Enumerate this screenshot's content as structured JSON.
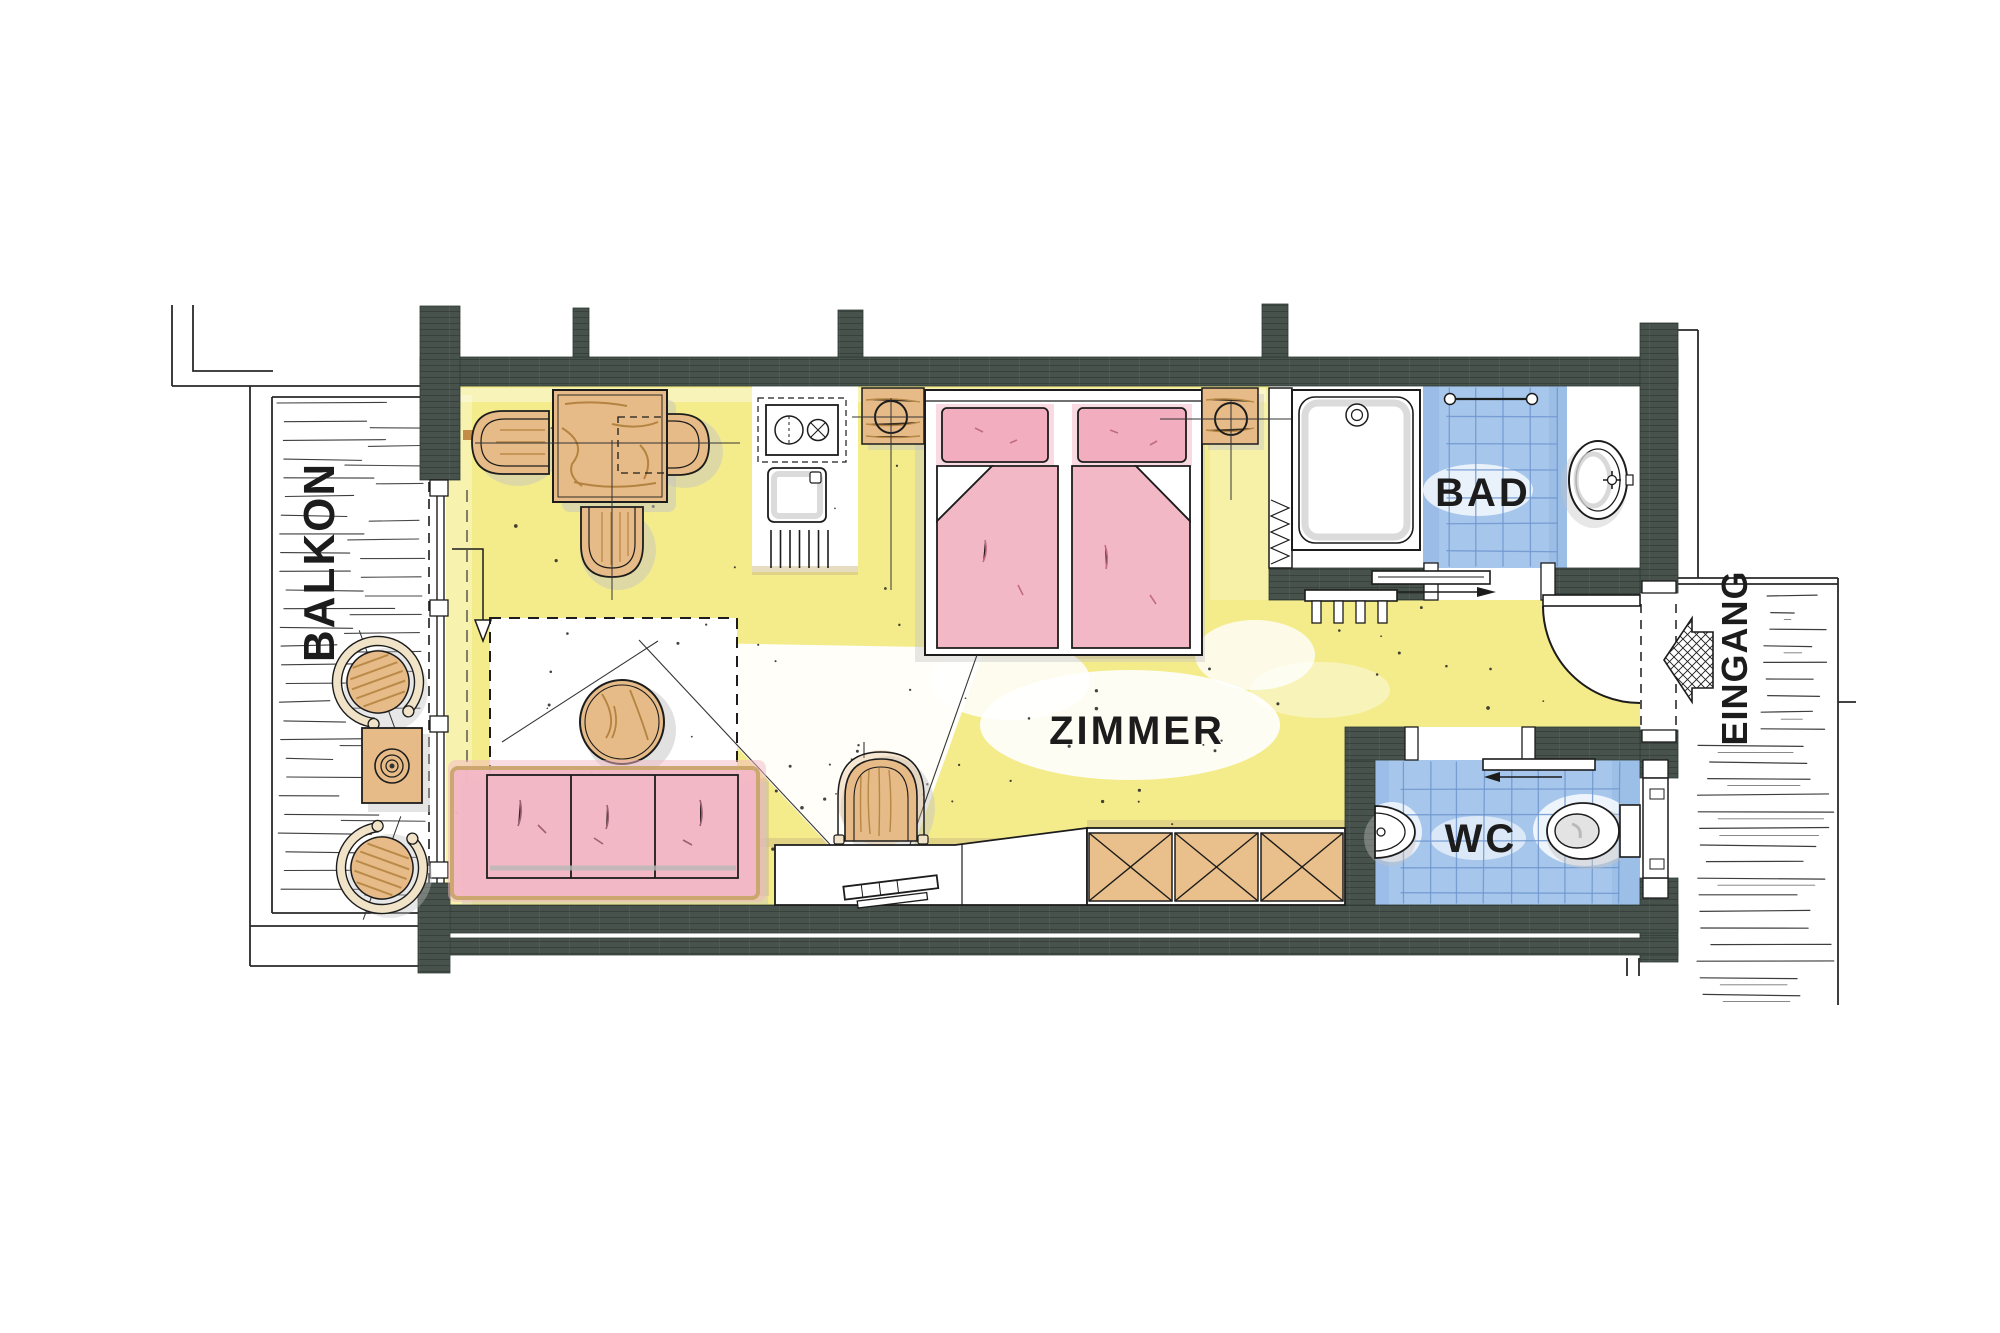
{
  "labels": {
    "balcony": "BALKON",
    "room": "ZIMMER",
    "bathroom": "BAD",
    "toilet": "WC",
    "entrance": "EINGANG"
  },
  "colors": {
    "wall": "#46524b",
    "floor_yellow": "#f4ec8b",
    "tile_blue": "#a6c6ec",
    "tile_grid": "#6f97cf",
    "textile_pink": "#f3b8c6",
    "pillow_pink": "#f2aebf",
    "wood_tan": "#e6bb88",
    "wood_grain": "#a8762f",
    "cream_band": "#f0e3c8",
    "shadow_gray": "#c3c3c3",
    "line_black": "#1c1c1c"
  },
  "furniture": {
    "balcony": [
      "round-chair",
      "round-chair",
      "side-table"
    ],
    "room": [
      "dining-table",
      "chair",
      "chair",
      "chair",
      "kitchenette-stove",
      "kitchenette-sink",
      "vent-grille",
      "nightstand-with-lamp",
      "double-bed",
      "nightstand-with-lamp",
      "rug",
      "coffee-table",
      "sofa-3-seat",
      "armchair",
      "sideboard",
      "tv",
      "wardrobe"
    ],
    "bathroom": [
      "shower-tub",
      "towel-rail",
      "washbasin",
      "towel-radiator",
      "sliding-door"
    ],
    "toilet": [
      "corner-washbasin",
      "toilet",
      "sliding-door",
      "swing-door"
    ],
    "entrance": [
      "entry-door",
      "direction-arrow"
    ]
  }
}
